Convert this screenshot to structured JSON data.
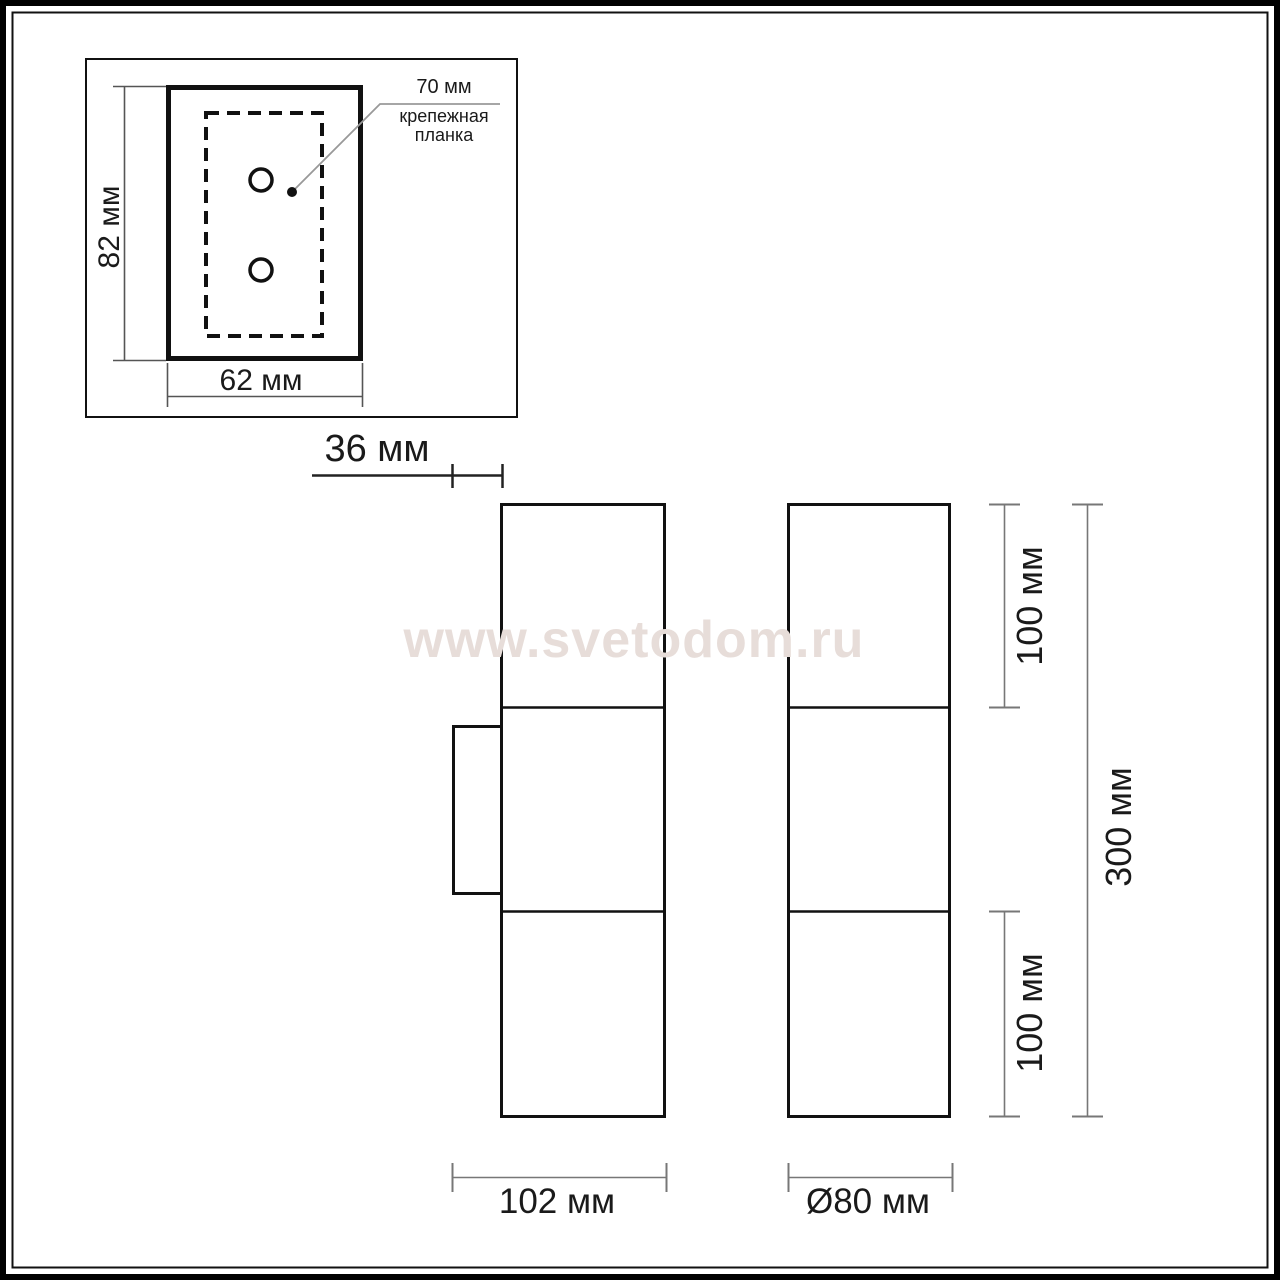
{
  "watermark": {
    "text": "www.svetodom.ru"
  },
  "colors": {
    "line": "#1a1a1a",
    "dim": "#777777",
    "dim_dark": "#444444",
    "leader": "#999999",
    "watermark": "#e7ddd9"
  },
  "detail_view": {
    "height": "82 мм",
    "width": "62 мм",
    "plate_width": "70 мм",
    "plate_name_line1": "крепежная",
    "plate_name_line2": "планка"
  },
  "side_views": {
    "bracket_depth": "36 мм",
    "top_section": "100 мм",
    "bottom_section": "100 мм",
    "total_height": "300 мм",
    "body_depth": "102 мм",
    "diameter": "Ø80 мм"
  }
}
